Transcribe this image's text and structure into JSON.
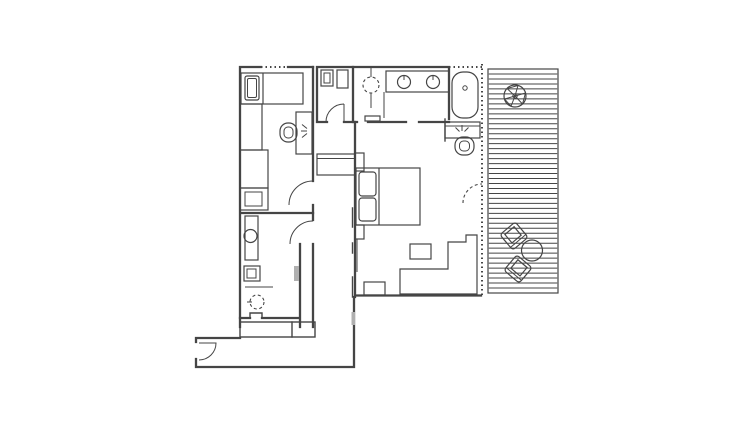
{
  "page": {
    "background": "#ffffff"
  },
  "drawing": {
    "type": "floor-plan",
    "line_color": "#454545",
    "light_gray": "#b0b0b0",
    "canvas": {
      "width": 754,
      "height": 435
    }
  },
  "deck": {
    "slat_count": 44,
    "orientation": "horizontal"
  },
  "rooms": [
    {
      "name": "small-bedroom",
      "position": "top-left"
    },
    {
      "name": "wc",
      "position": "top-middle"
    },
    {
      "name": "bathroom",
      "position": "top-right"
    },
    {
      "name": "master-bedroom",
      "position": "center-right"
    },
    {
      "name": "lower-bathroom",
      "position": "bottom-left"
    },
    {
      "name": "hallway",
      "position": "center"
    },
    {
      "name": "entry-corridor",
      "position": "bottom"
    },
    {
      "name": "deck",
      "position": "right"
    }
  ],
  "furniture": [
    {
      "item": "single-bed",
      "room": "small-bedroom"
    },
    {
      "item": "wardrobe",
      "room": "small-bedroom"
    },
    {
      "item": "cabinet",
      "room": "small-bedroom"
    },
    {
      "item": "desk",
      "room": "small-bedroom"
    },
    {
      "item": "desk-chair",
      "room": "small-bedroom"
    },
    {
      "item": "wall-lamp",
      "room": "small-bedroom"
    },
    {
      "item": "toilet",
      "room": "wc"
    },
    {
      "item": "washbasin",
      "room": "wc"
    },
    {
      "item": "vanity-two-sinks",
      "room": "bathroom"
    },
    {
      "item": "ceiling-light",
      "room": "bathroom"
    },
    {
      "item": "bathtub",
      "room": "bathroom"
    },
    {
      "item": "desk",
      "room": "master-bedroom"
    },
    {
      "item": "desk-chair",
      "room": "master-bedroom"
    },
    {
      "item": "wall-lamp",
      "room": "master-bedroom"
    },
    {
      "item": "double-bed",
      "room": "master-bedroom"
    },
    {
      "item": "side-table",
      "room": "master-bedroom"
    },
    {
      "item": "sofa",
      "room": "master-bedroom"
    },
    {
      "item": "bench",
      "room": "master-bedroom"
    },
    {
      "item": "hall-closet",
      "room": "hallway"
    },
    {
      "item": "counter",
      "room": "lower-bathroom"
    },
    {
      "item": "round-sink",
      "room": "lower-bathroom"
    },
    {
      "item": "washer",
      "room": "lower-bathroom"
    },
    {
      "item": "ceiling-light",
      "room": "lower-bathroom"
    },
    {
      "item": "potted-plant",
      "room": "deck"
    },
    {
      "item": "round-table",
      "room": "deck"
    },
    {
      "item": "deck-chair",
      "room": "deck"
    },
    {
      "item": "deck-chair",
      "room": "deck"
    }
  ]
}
